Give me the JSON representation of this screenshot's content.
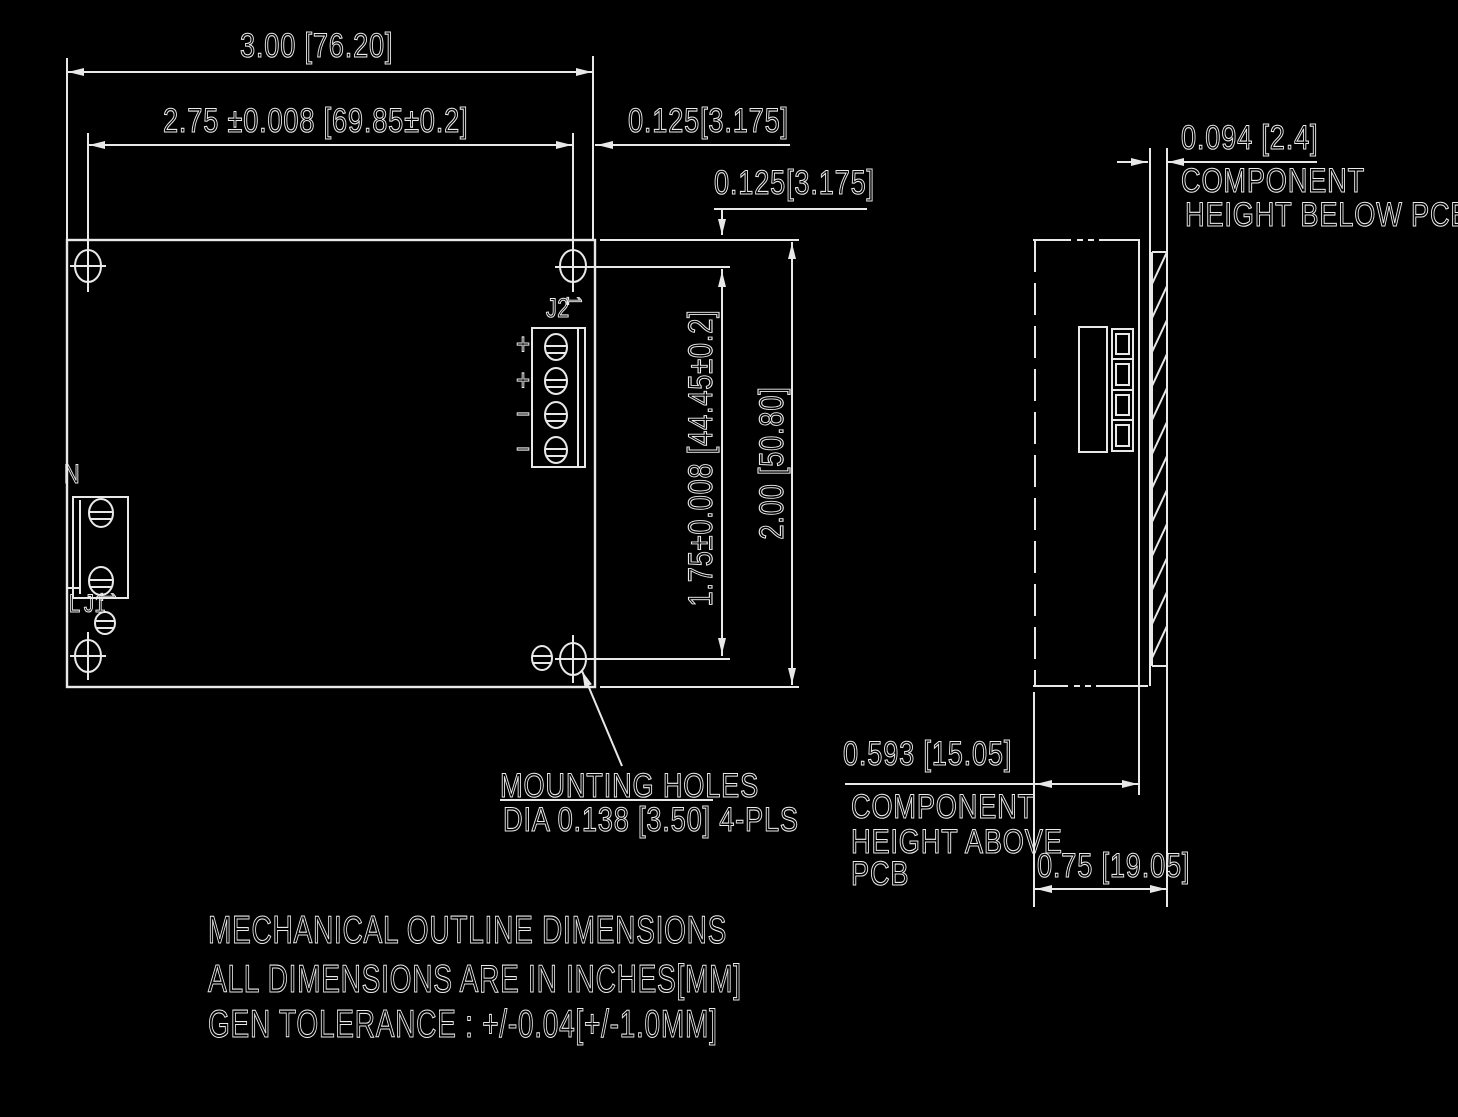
{
  "drawing": {
    "dimensions": {
      "overall_width": "3.00 [76.20]",
      "hole_span_width": "2.75 ±0.008 [69.85±0.2]",
      "edge_offset_right": "0.125[3.175]",
      "edge_offset_top": "0.125[3.175]",
      "hole_span_height": "1.75±0.008 [44.45±0.2]",
      "overall_height": "2.00 [50.80]",
      "component_height_below": "0.094 [2.4]",
      "component_height_above": "0.593 [15.05]",
      "overall_depth": "0.75 [19.05]"
    },
    "callouts": {
      "component_below_line1": "COMPONENT",
      "component_below_line2": "HEIGHT BELOW PCB",
      "component_above_line1": "COMPONENT",
      "component_above_line2": "HEIGHT ABOVE",
      "component_above_line3": "PCB",
      "mounting_holes_title": "MOUNTING HOLES",
      "mounting_holes_detail": "DIA 0.138 [3.50] 4-PLS"
    },
    "labels": {
      "connector_j2": "J2",
      "connector_j1": "J1",
      "pin1_marker": "1",
      "neutral": "N",
      "line": "L",
      "plus_a": "+",
      "plus_b": "+",
      "minus_a": "−",
      "minus_b": "−"
    },
    "notes": {
      "line1": "MECHANICAL OUTLINE DIMENSIONS",
      "line2": "ALL DIMENSIONS ARE IN INCHES[MM]",
      "line3": "GEN TOLERANCE : +/-0.04[+/-1.0MM]"
    },
    "colors": {
      "background": "#000000",
      "line": "#e8e8e8"
    }
  }
}
